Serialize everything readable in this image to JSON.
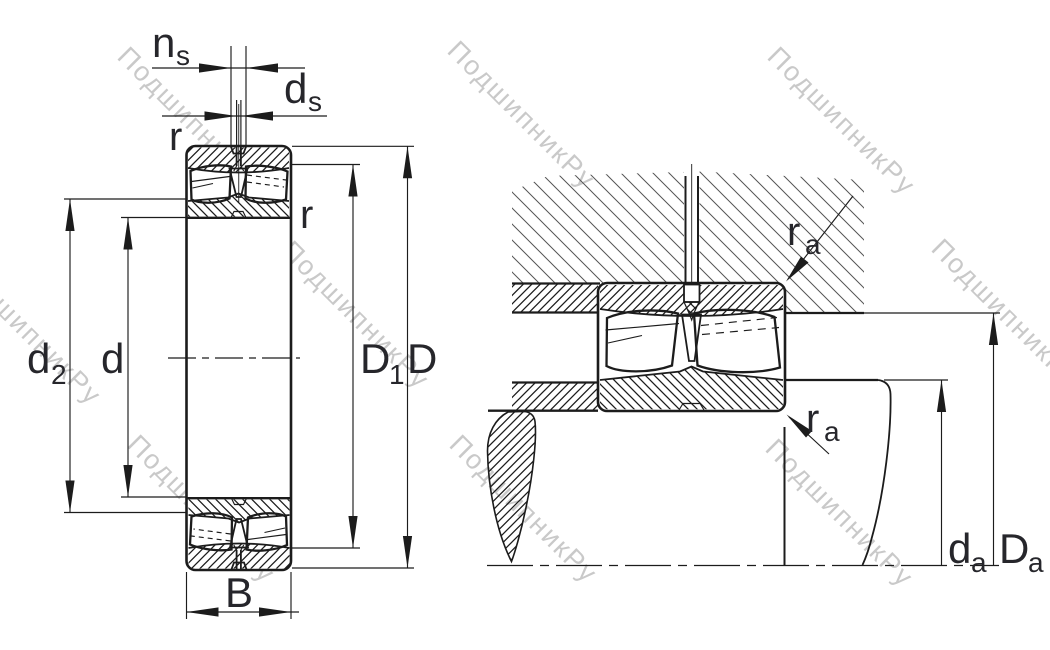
{
  "watermark": {
    "text": "ПодшипникРу"
  },
  "labels": {
    "ns": {
      "main": "n",
      "sub": "s"
    },
    "ds": {
      "main": "d",
      "sub": "s"
    },
    "r_left": "r",
    "r_right": "r",
    "d2": {
      "main": "d",
      "sub": "2"
    },
    "d": "d",
    "D1": {
      "main": "D",
      "sub": "1"
    },
    "D": "D",
    "B": "B",
    "ra_top": {
      "main": "r",
      "sub": "a"
    },
    "ra_bottom": {
      "main": "r",
      "sub": "a"
    },
    "da": {
      "main": "d",
      "sub": "a"
    },
    "Da": {
      "main": "D",
      "sub": "a"
    }
  },
  "colors": {
    "line": "#1c1c1c",
    "label": "#26262b",
    "housing_hatch": "#555555",
    "watermark": "#c9c9c9",
    "background": "#ffffff"
  }
}
